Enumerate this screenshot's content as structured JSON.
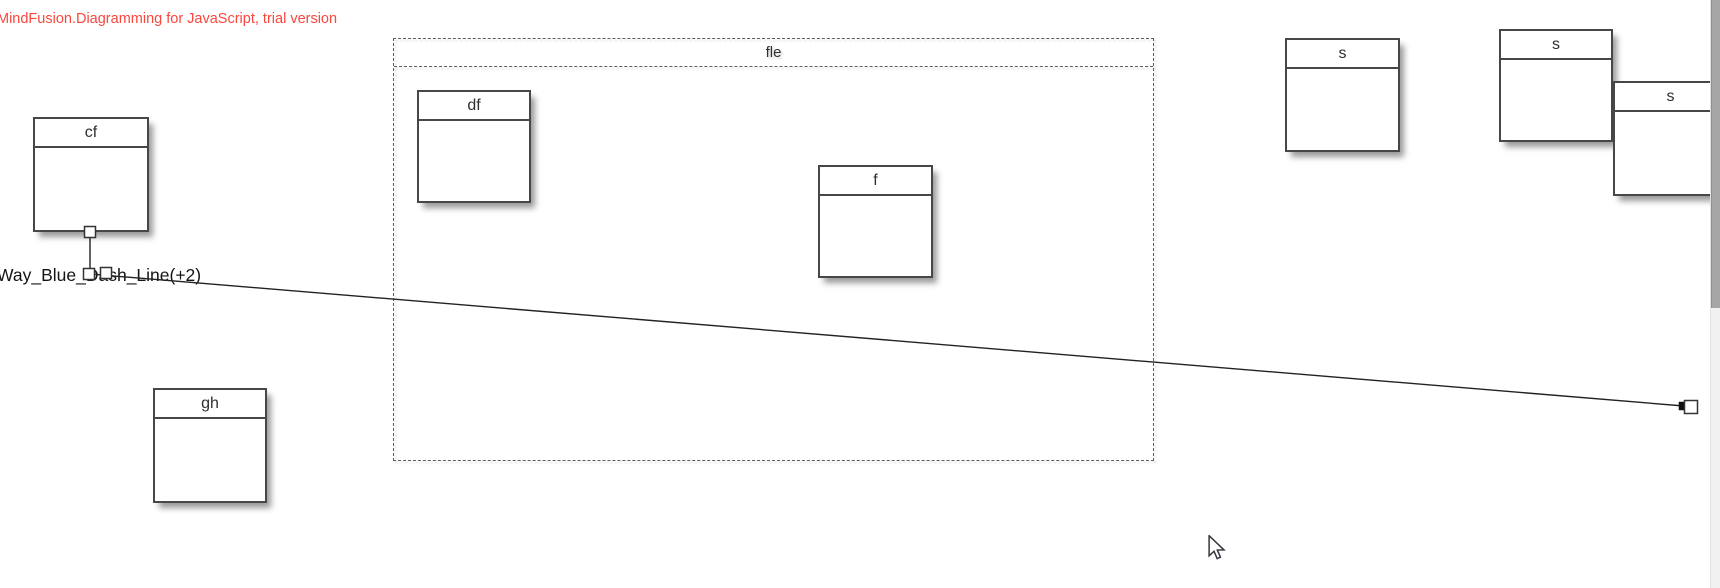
{
  "app": {
    "trial_notice": "MindFusion.Diagramming for JavaScript, trial version",
    "trial_notice_color": "#fa473e"
  },
  "diagram": {
    "container": {
      "id": "fle",
      "label": "fle",
      "x": 393,
      "y": 38,
      "w": 761,
      "h": 423
    },
    "nodes": [
      {
        "id": "cf",
        "label": "cf",
        "x": 33,
        "y": 117,
        "w": 116,
        "h": 115
      },
      {
        "id": "gh",
        "label": "gh",
        "x": 153,
        "y": 388,
        "w": 114,
        "h": 115
      },
      {
        "id": "df",
        "label": "df",
        "x": 417,
        "y": 90,
        "w": 114,
        "h": 113
      },
      {
        "id": "f",
        "label": "f",
        "x": 818,
        "y": 165,
        "w": 115,
        "h": 113
      },
      {
        "id": "s1",
        "label": "s",
        "x": 1285,
        "y": 38,
        "w": 115,
        "h": 114
      },
      {
        "id": "s2",
        "label": "s",
        "x": 1499,
        "y": 29,
        "w": 114,
        "h": 113
      },
      {
        "id": "s3",
        "label": "s",
        "x": 1613,
        "y": 81,
        "w": 115,
        "h": 115
      }
    ],
    "link": {
      "label": "Way_Blue_Dash_Line(+2)",
      "color": "#222222",
      "points": [
        [
          90,
          232
        ],
        [
          90,
          274
        ],
        [
          1684,
          406
        ]
      ],
      "handles": [
        [
          90,
          232
        ],
        [
          89,
          274
        ],
        [
          106,
          273
        ]
      ],
      "end_arrow": [
        1683,
        406
      ],
      "end_handle": [
        1691,
        407
      ]
    }
  },
  "scrollbar": {
    "thumb_top": 0,
    "thumb_height": 308
  },
  "cursor": {
    "x": 1207,
    "y": 535
  }
}
